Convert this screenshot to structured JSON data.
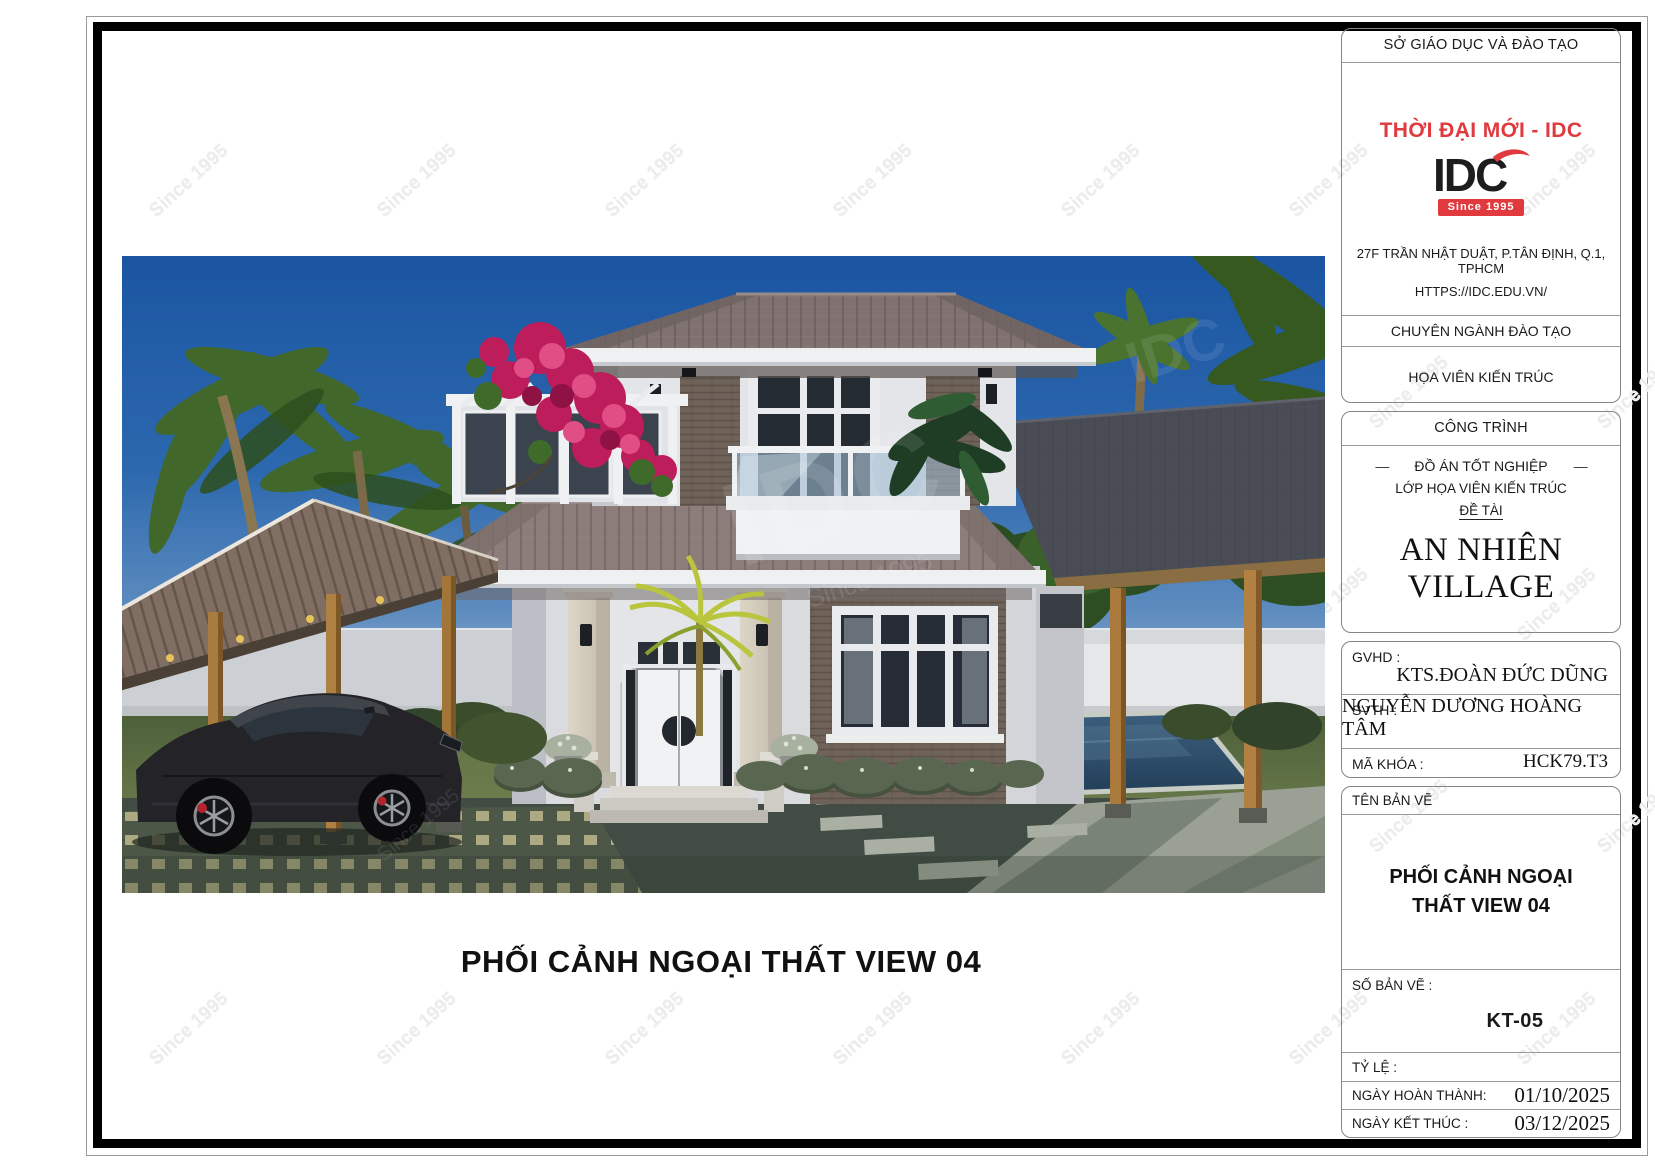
{
  "sheet": {
    "watermark": "Since 1995",
    "watermark_idc": "IDC"
  },
  "drawing": {
    "caption": "PHỐI CẢNH NGOẠI THẤT VIEW 04"
  },
  "title_block": {
    "org_header": "SỞ GIÁO DỤC VÀ ĐÀO TẠO",
    "logo": {
      "tagline": "THỜI ĐẠI MỚI - IDC",
      "name": "IDC",
      "since": "Since 1995"
    },
    "address_line1": "27F TRẦN NHẬT DUẬT, P.TÂN ĐỊNH, Q.1, TPHCM",
    "address_line2": "HTTPS://IDC.EDU.VN/",
    "major_header": "CHUYÊN NGÀNH ĐÀO TẠO",
    "major_value": "HỌA VIÊN KIẾN TRÚC",
    "project": {
      "header": "CÔNG TRÌNH",
      "dash": "—",
      "line1": "ĐỒ ÁN TỐT NGHIỆP",
      "line2": "LỚP HỌA VIÊN KIẾN TRÚC",
      "line3": "ĐỀ TÀI",
      "name": "AN NHIÊN VILLAGE"
    },
    "people": {
      "gvhd_label": "GVHD :",
      "gvhd_value": "KTS.ĐOÀN ĐỨC DŨNG",
      "svth_label": "SVTH :",
      "svth_value": "NGUYỄN DƯƠNG HOÀNG TÂM",
      "makhoa_label": "MÃ KHÓA :",
      "makhoa_value": "HCK79.T3"
    },
    "sheet_info": {
      "ten_ban_ve_label": "TÊN BẢN VẼ",
      "drawing_title_line1": "PHỐI CẢNH NGOẠI",
      "drawing_title_line2": "THẤT VIEW 04",
      "so_ban_ve_label": "SỐ BẢN VẼ :",
      "so_ban_ve_value": "KT-05",
      "ty_le_label": "TỶ LỆ :",
      "ngay_hoan_thanh_label": "NGÀY HOÀN THÀNH:",
      "ngay_hoan_thanh_value": "01/10/2025",
      "ngay_ket_thuc_label": "NGÀY KẾT THÚC :",
      "ngay_ket_thuc_value": "03/12/2025"
    }
  },
  "colors": {
    "accent_red": "#E03A3E",
    "frame_black": "#000000",
    "box_border": "#858585",
    "watermark_gray": "#ECECEC",
    "sky_blue": "#1B55A2",
    "bougainvillea_pink": "#BD1D5A"
  }
}
